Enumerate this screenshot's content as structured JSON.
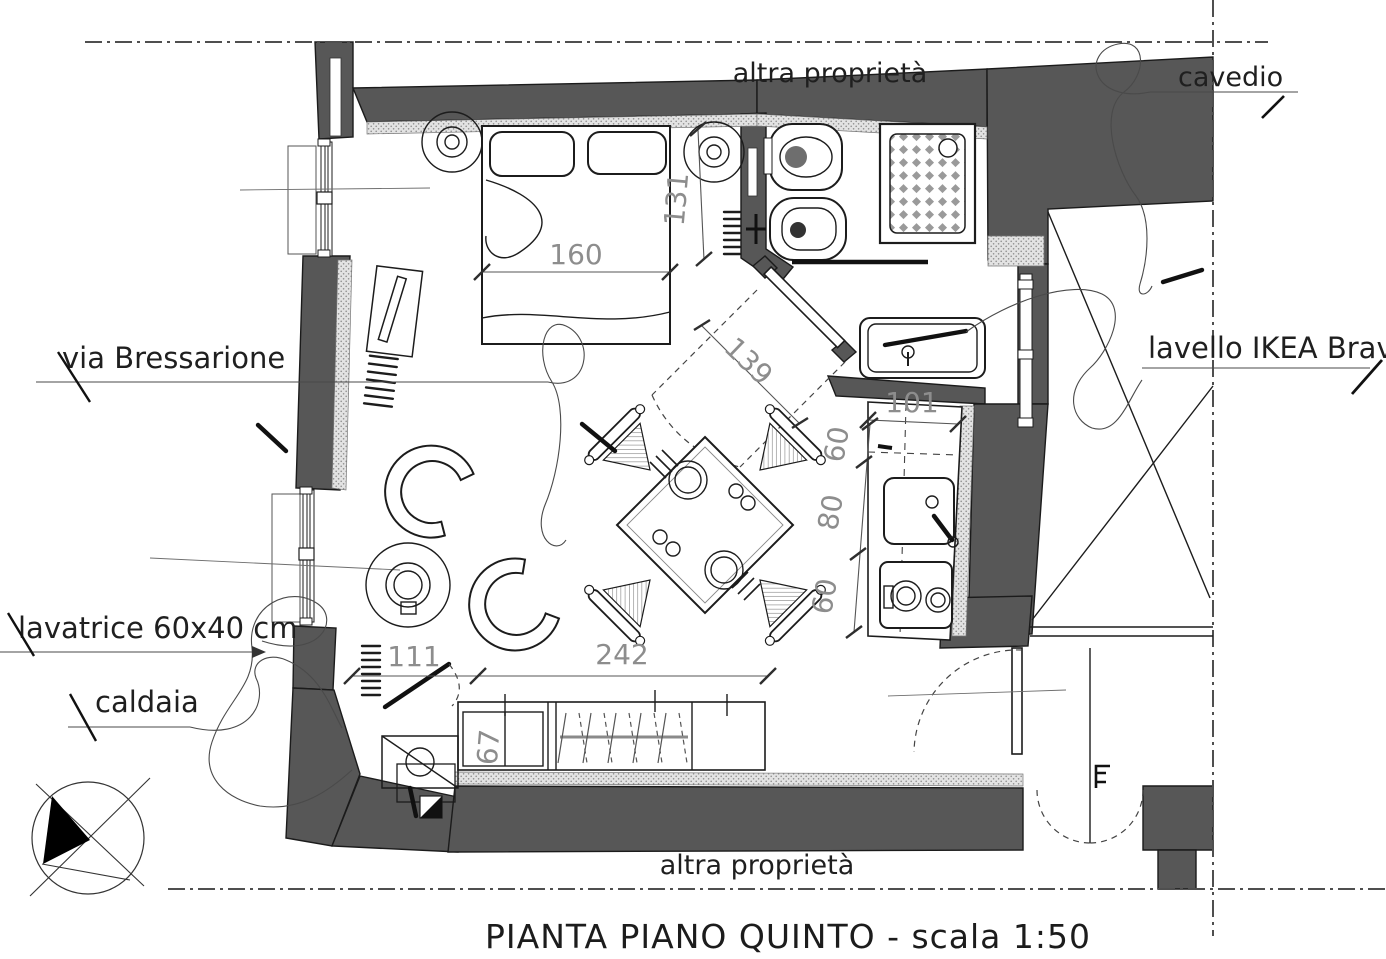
{
  "title": "PIANTA PIANO QUINTO  - scala 1:50",
  "labels": {
    "top_property": "altra proprietà",
    "bottom_property": "altra proprietà",
    "cavedio": "cavedio",
    "street": "via Bressarione",
    "washer": "lavatrice 60x40 cm",
    "boiler": "caldaia",
    "sink_label": "lavello IKEA Braviken"
  },
  "dimensions": {
    "bed_width": "160",
    "bath_width": "131",
    "bath_door": "139",
    "kitchen_length": "101",
    "kitchen_seg_top": "60",
    "kitchen_seg_mid": "80",
    "kitchen_seg_bottom": "60",
    "opening_width": "111",
    "wardrobe_width": "242",
    "wardrobe_depth": "67"
  },
  "colors": {
    "wall": "#575757",
    "line": "#1c1c1c",
    "dimension_text": "#8d8d8d",
    "stipple": "#8f8f8f"
  }
}
